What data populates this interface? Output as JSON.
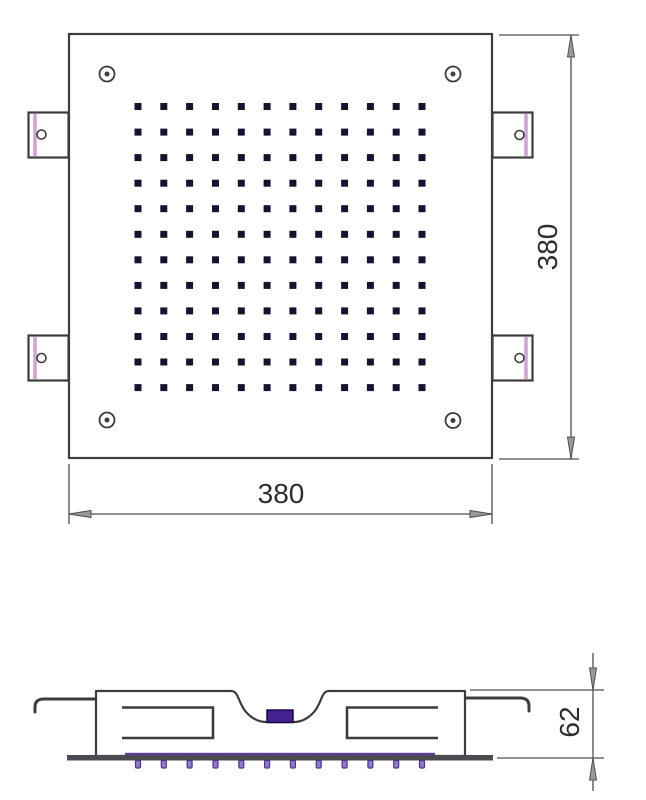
{
  "drawing": {
    "title": "shower-head-technical-drawing",
    "top_view": {
      "width_dim": {
        "label": "380"
      },
      "height_dim": {
        "label": "380"
      },
      "nozzle_grid": {
        "rows": 12,
        "cols": 12,
        "x0": 138,
        "y0": 106.5,
        "dx": 25.82,
        "dy": 25.55,
        "size": 7
      },
      "screw_hole_count": 4,
      "mounting_tab_count": 4
    },
    "side_view": {
      "depth_dim": {
        "label": "62"
      },
      "nozzle_row": {
        "count": 12,
        "x0": 138,
        "dx": 25.82,
        "y": 760.5,
        "w": 5,
        "h": 7.5
      }
    },
    "colors": {
      "line": "#3d3d3d",
      "dim_line": "#4f4f4f",
      "nozzle_dark": "#171230",
      "inlet_purple": "#44218F",
      "inlet_border": "#22094e",
      "tab_stripe_pink": "#D1A3D6",
      "side_nozzle_fill": "#8F7BC8",
      "side_nozzle_stroke": "#4a3596",
      "plate_bar": "#4a4a50",
      "plate_purple_line": "#5C3D94"
    }
  }
}
